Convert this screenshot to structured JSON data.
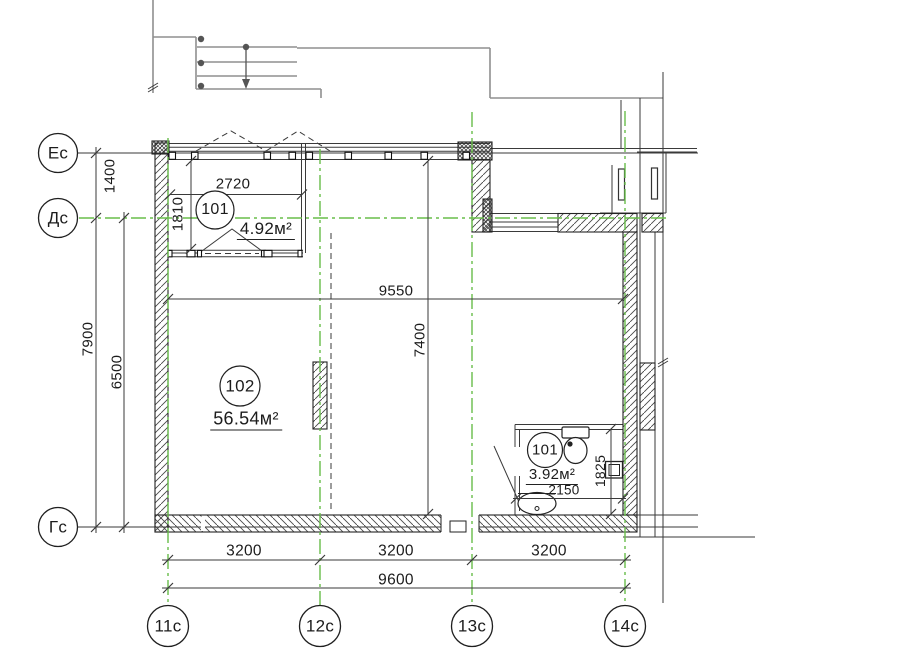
{
  "axes": {
    "rows": [
      {
        "label": "Ес"
      },
      {
        "label": "Дс"
      },
      {
        "label": "Гс"
      }
    ],
    "cols": [
      {
        "label": "11с"
      },
      {
        "label": "12с"
      },
      {
        "label": "13с"
      },
      {
        "label": "14с"
      }
    ]
  },
  "rooms": [
    {
      "tag": "101",
      "area": "4.92м²"
    },
    {
      "tag": "102",
      "area": "56.54м²"
    },
    {
      "tag": "101",
      "area": "3.92м²"
    }
  ],
  "dims": {
    "v1400": "1400",
    "v7900": "7900",
    "v6500": "6500",
    "loggia_width": "2720",
    "loggia_depth": "1810",
    "room_width": "9550",
    "room_depth": "7400",
    "bath_width": "2150",
    "bath_depth": "1825",
    "bay1": "3200",
    "bay2": "3200",
    "bay3": "3200",
    "total": "9600"
  },
  "colors": {
    "grid_green": "#68bd4a",
    "line_dark": "#2e2e2e",
    "outline_gray": "#8f8f8f",
    "paper": "#ffffff"
  }
}
